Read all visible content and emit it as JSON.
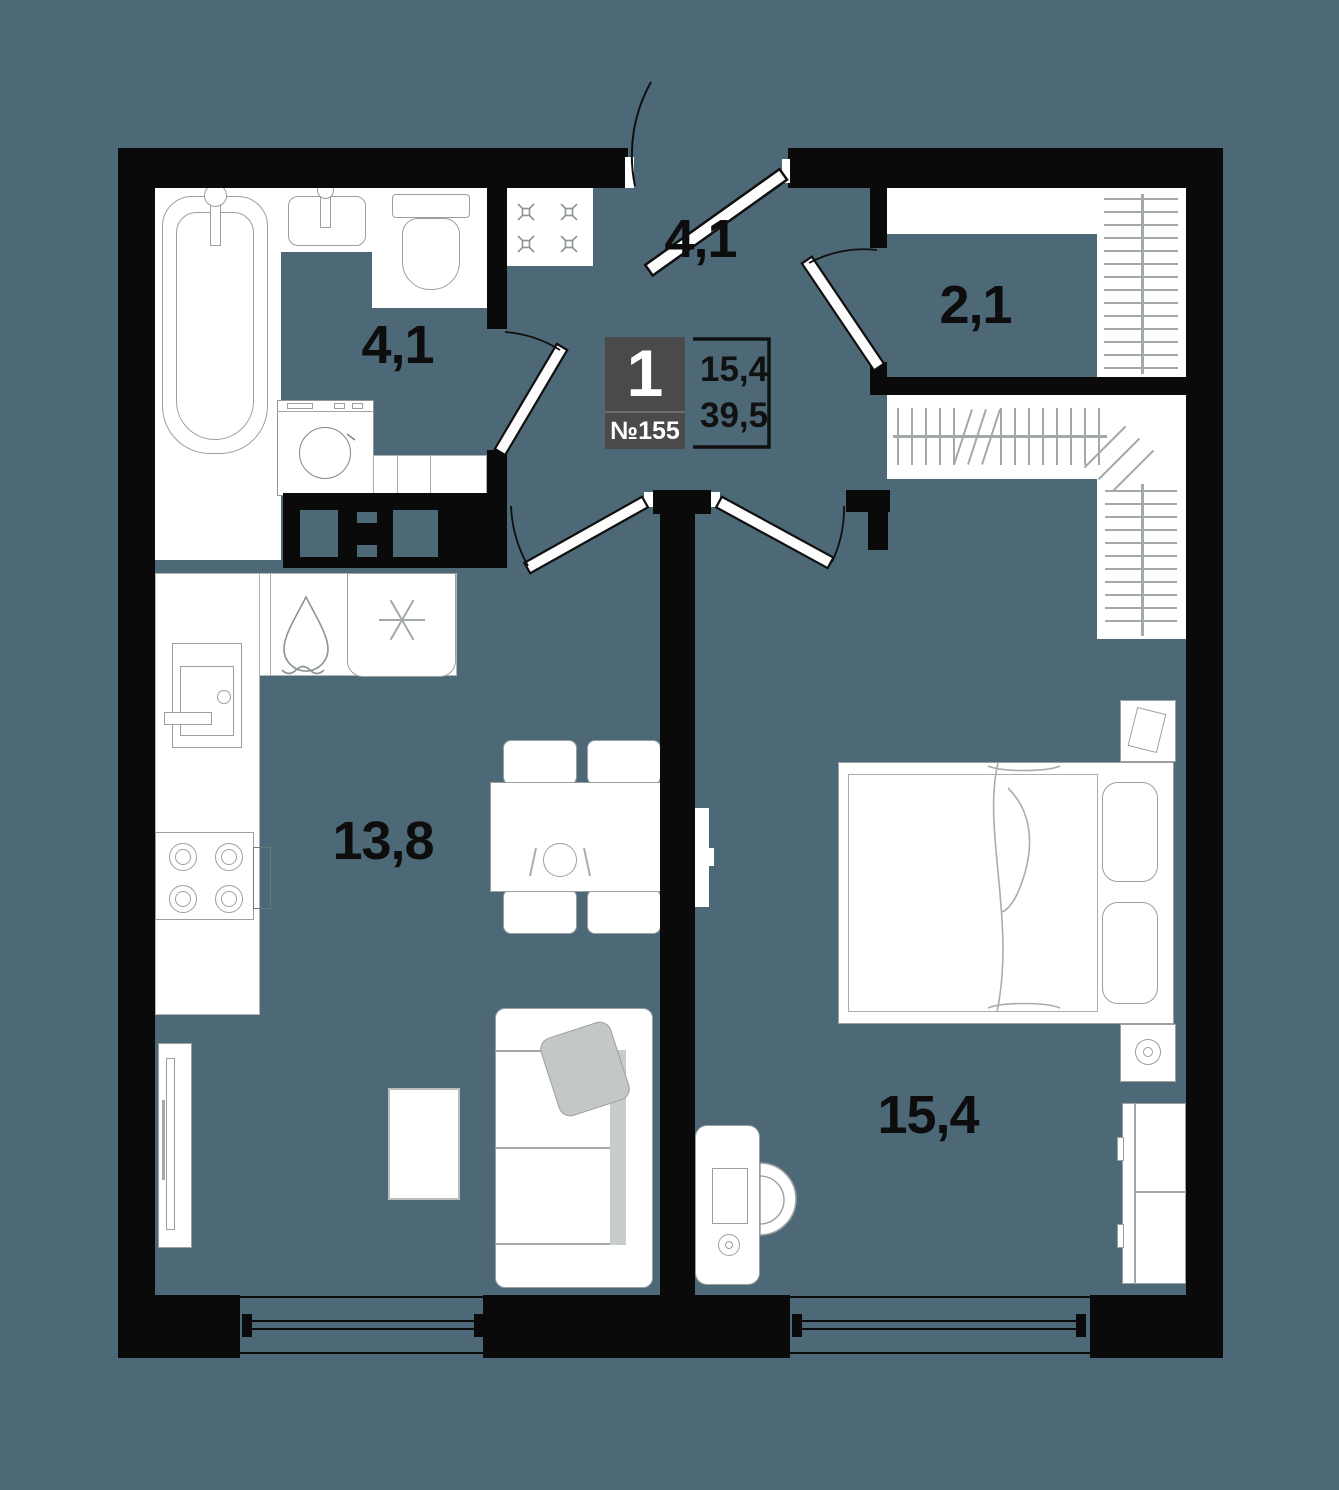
{
  "colors": {
    "floor": "#4d6876",
    "wall": "#0a0a0a",
    "card_background": "#4a4a4a",
    "card_text": "#ffffff",
    "furniture_outline": "#9aa0a0",
    "soft_gray_fill": "#c5c8c8",
    "label_text": "#0d0d0d"
  },
  "unit_card": {
    "rooms_count": "1",
    "unit_number": "№155",
    "living_area": "15,4",
    "total_area": "39,5"
  },
  "rooms": [
    {
      "name": "hallway",
      "area": "4,1"
    },
    {
      "name": "bathroom",
      "area": "4,1"
    },
    {
      "name": "wardrobe",
      "area": "2,1"
    },
    {
      "name": "kitchen-living-room",
      "area": "13,8"
    },
    {
      "name": "bedroom",
      "area": "15,4"
    }
  ],
  "icons": [
    "bathtub-icon",
    "bath-sink-icon",
    "toilet-icon",
    "washing-machine-icon",
    "hob-icon",
    "water-drop-icon",
    "fridge-snowflake-icon",
    "kitchen-sink-icon",
    "stove-burners-icon",
    "radiator-icon",
    "dining-table-icon",
    "plate-icon",
    "chair-icon",
    "sofa-icon",
    "pillow-icon",
    "coffee-table-icon",
    "double-bed-icon",
    "nightstand-icon",
    "lamp-icon",
    "book-icon",
    "tv-icon",
    "desk-icon",
    "desk-chair-icon",
    "hanger-rail-icon",
    "cabinet-icon",
    "entrance-door-icon",
    "interior-door-icon",
    "window-icon"
  ]
}
